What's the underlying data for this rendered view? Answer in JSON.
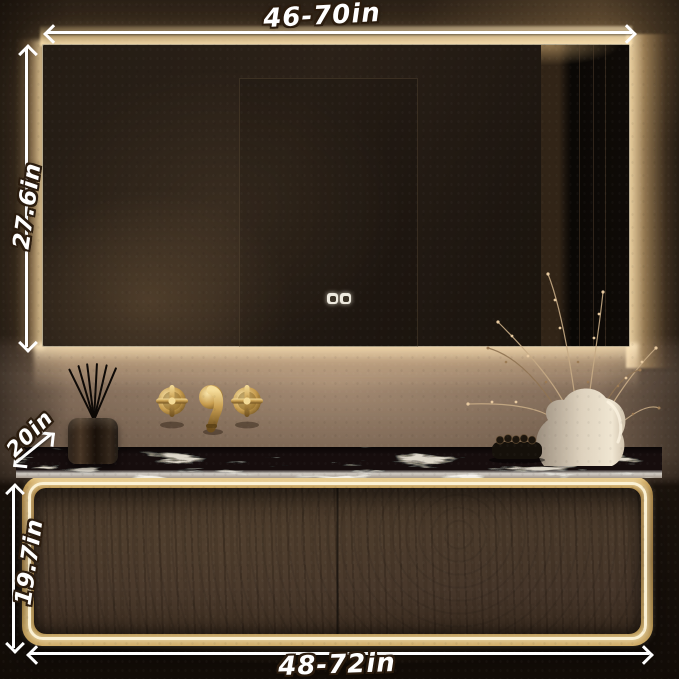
{
  "annotations": {
    "mirror_width": "46-70in",
    "mirror_height": "27.6in",
    "counter_depth": "20in",
    "cabinet_height": "19.7in",
    "cabinet_width": "48-72in"
  },
  "mirror": {
    "touch_buttons": [
      "defog-touch-button",
      "light-touch-button"
    ]
  },
  "palette": {
    "led_warm_white": "#fdf3d8",
    "gold_frame": "#c9a254",
    "wood_drawer": "#46362a",
    "marble_light": "#ded7c9",
    "marble_vein": "#12100c",
    "wall_lit": "#7b6757",
    "wall_dark": "#241b13",
    "annotation_text": "#ffffff",
    "annotation_outline": "#2b1c0e"
  },
  "scene_objects": [
    "backlit-led-mirror",
    "wall-mount-gold-faucet",
    "reed-diffuser",
    "marble-countertop",
    "led-floating-vanity",
    "ceramic-vase",
    "dried-branches",
    "black-brush-set"
  ]
}
